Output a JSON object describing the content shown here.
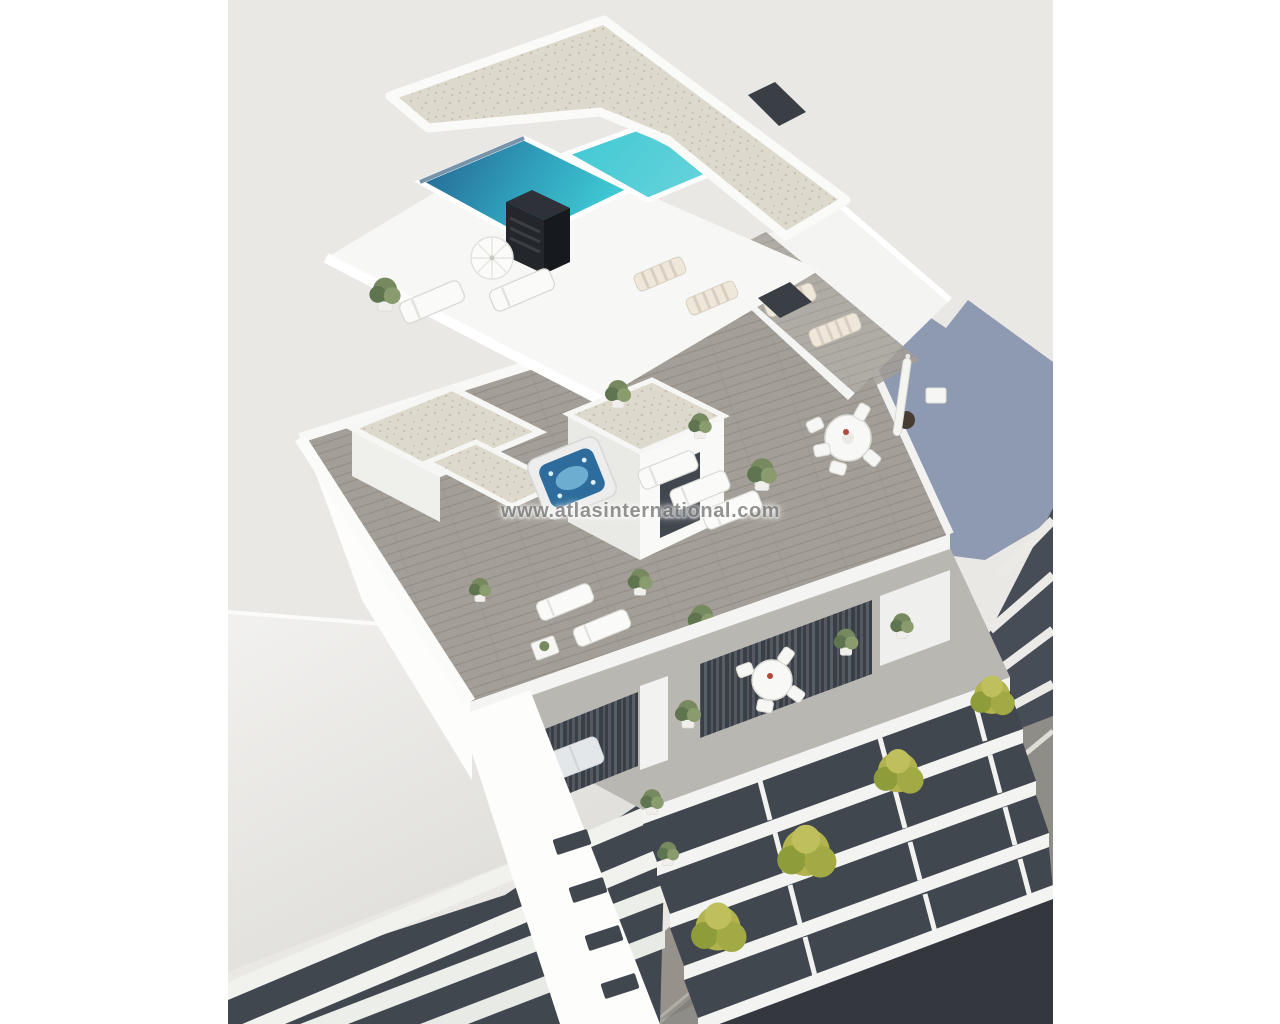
{
  "image": {
    "kind": "architectural-3d-render",
    "view": "aerial isometric view of a modern white apartment building",
    "features": [
      "rooftop swimming pool with turquoise water",
      "gravel-topped penthouse roofs",
      "roof deck with jacuzzi hot tub",
      "sun loungers and open parasol",
      "round outdoor dining tables with chairs",
      "potted plants and planters",
      "balconies with sofas and curtained glass doors",
      "neighbouring slab-balcony buildings",
      "street with white lane markings and sidewalk trees",
      "blue cast shadow on backdrop"
    ]
  },
  "watermark": {
    "text": "www.atlasinternational.com"
  },
  "palette": {
    "page-bg": "#ffffff",
    "canvas-bg": "#eae8e5",
    "building-white": "#f7f7f5",
    "wall-bright": "#fdfdfc",
    "wall-shade": "#d9d9d6",
    "beam-shadow": "#b9b8b3",
    "deck": "#a39e97",
    "deck-line": "#938d86",
    "gravel": "#ded9cd",
    "gravel-dot": "#c6c0b1",
    "pool-deep": "#255f8e",
    "pool-bright": "#3fc8d3",
    "pool-bright-2": "#63d2da",
    "jacuzzi-water": "#2d6c9c",
    "jacuzzi-light": "#79b8d8",
    "balcony-floor": "#b9b7b2",
    "dark-recess": "#3a3f46",
    "curtain": "#565e68",
    "glass-dark": "#41474f",
    "chimney-dark": "#23262b",
    "shadow-blue": "#8591ae",
    "street-asphalt": "#8f8d88",
    "sidewalk": "#a7a39c",
    "road-line": "#dfddd6",
    "curb-line": "#c9c6bf",
    "tree-yellow": "#b2b34f",
    "tree-yellow-dark": "#8f9c3a",
    "plant-green": "#77895f",
    "plant-green-dark": "#5f7550",
    "lounger-stripe": "#d8cfc0",
    "watermark-gray": "#858585"
  }
}
